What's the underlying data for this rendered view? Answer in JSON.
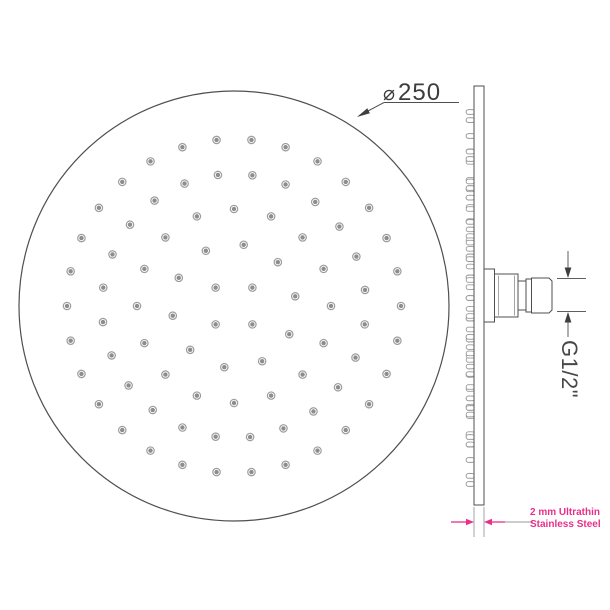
{
  "labels": {
    "diameter_symbol": "⌀",
    "diameter_value": "250",
    "thread": "G1/2\"",
    "thickness_line1": "2 mm Ultrathin",
    "thickness_line2": "Stainless Steel"
  },
  "colors": {
    "line": "#4f4f4f",
    "soft": "#9a9a9a",
    "dim": "#5f5f5f",
    "arrow": "#3f3f3f",
    "accent": "#e8308a",
    "dot_ring": "#9c9c9c",
    "dot_fill": "#8d8d8d",
    "text": "#3d3d3d"
  },
  "face_view": {
    "cx": 234,
    "cy": 306,
    "r": 215,
    "dot_outer_r": 3.7,
    "dot_inner_r": 2.2,
    "rings": [
      {
        "r": 26,
        "count": 4,
        "start": 45
      },
      {
        "r": 62,
        "count": 10,
        "start": 27
      },
      {
        "r": 97,
        "count": 16,
        "start": 0
      },
      {
        "r": 132,
        "count": 24,
        "start": 8
      },
      {
        "r": 167,
        "count": 30,
        "start": 0
      }
    ]
  },
  "side_view": {
    "bump_x": 466.2,
    "bump_w": 8.2,
    "bump_h": 4.6,
    "bump_center_y": 298,
    "bump_scale": 1.12
  },
  "geometry": {
    "leader": [
      {
        "t": "line",
        "x1": 384,
        "y1": 102.5,
        "x2": 459,
        "y2": 102.5,
        "s": "line",
        "sw": 1
      },
      {
        "t": "line",
        "x1": 384,
        "y1": 102.5,
        "x2": 359.5,
        "y2": 115.5,
        "s": "line",
        "sw": 1
      },
      {
        "t": "poly",
        "pts": "357,117 367.3,108.3 369.9,113.3",
        "f": "arrow"
      }
    ],
    "plate": [
      {
        "t": "rect",
        "x": 474,
        "y": 86,
        "w": 10,
        "h": 419,
        "s": "line",
        "sw": 1,
        "f": "#fff"
      }
    ],
    "connector": [
      {
        "t": "rect",
        "x": 484,
        "y": 269,
        "w": 10.5,
        "h": 53,
        "s": "line",
        "sw": 1,
        "f": "#fff"
      },
      {
        "t": "rect",
        "x": 494.5,
        "y": 274,
        "w": 23.5,
        "h": 43,
        "s": "line",
        "sw": 1,
        "f": "#fff"
      },
      {
        "t": "line",
        "x1": 498.5,
        "y1": 275.5,
        "x2": 498.5,
        "y2": 315.5,
        "s": "soft",
        "sw": 0.9
      },
      {
        "t": "line",
        "x1": 514.5,
        "y1": 275.5,
        "x2": 514.5,
        "y2": 315.5,
        "s": "soft",
        "sw": 0.9
      },
      {
        "t": "rect",
        "x": 518,
        "y": 281,
        "w": 8,
        "h": 29,
        "s": "line",
        "sw": 1,
        "f": "#fff"
      },
      {
        "t": "rect",
        "x": 526,
        "y": 279,
        "w": 5.5,
        "h": 33,
        "s": "line",
        "sw": 1,
        "f": "#fff"
      },
      {
        "t": "poly",
        "pts": "531.5,278 549,278 552,281 552,310 549,313 531.5,313",
        "f": "#fff",
        "s": "line",
        "sw": 1
      }
    ],
    "thread_dim": [
      {
        "t": "line",
        "x1": 568,
        "y1": 251,
        "x2": 568,
        "y2": 268,
        "s": "dim",
        "sw": 1
      },
      {
        "t": "poly",
        "pts": "568,278 564.6,267.5 571.4,267.5",
        "f": "arrow"
      },
      {
        "t": "line",
        "x1": 557,
        "y1": 278.5,
        "x2": 586,
        "y2": 278.5,
        "s": "dim",
        "sw": 1
      },
      {
        "t": "line",
        "x1": 557,
        "y1": 311.5,
        "x2": 586,
        "y2": 311.5,
        "s": "dim",
        "sw": 1
      },
      {
        "t": "poly",
        "pts": "568,312 564.6,322.5 571.4,322.5",
        "f": "arrow"
      },
      {
        "t": "line",
        "x1": 568,
        "y1": 322.5,
        "x2": 568,
        "y2": 337,
        "s": "dim",
        "sw": 1
      }
    ],
    "thickness_dim": [
      {
        "t": "line",
        "x1": 474,
        "y1": 507,
        "x2": 474,
        "y2": 537,
        "s": "soft",
        "sw": 0.9
      },
      {
        "t": "line",
        "x1": 484,
        "y1": 507,
        "x2": 484,
        "y2": 537,
        "s": "soft",
        "sw": 0.9
      },
      {
        "t": "line",
        "x1": 451,
        "y1": 522,
        "x2": 467,
        "y2": 522,
        "s": "accent",
        "sw": 1.3
      },
      {
        "t": "poly",
        "pts": "474,522 466,518.8 466,525.2",
        "f": "accent"
      },
      {
        "t": "poly",
        "pts": "484,522 492,518.8 492,525.2",
        "f": "accent"
      },
      {
        "t": "line",
        "x1": 491,
        "y1": 522,
        "x2": 505,
        "y2": 522,
        "s": "accent",
        "sw": 1.3
      },
      {
        "t": "line",
        "x1": 505,
        "y1": 522,
        "x2": 533,
        "y2": 522,
        "s": "soft",
        "sw": 0.9
      }
    ]
  }
}
